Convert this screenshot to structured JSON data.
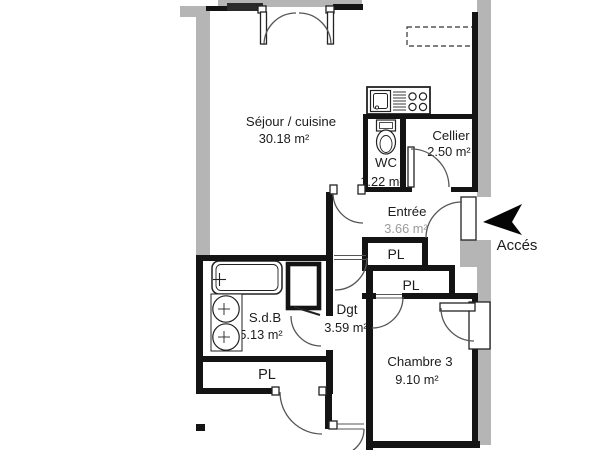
{
  "plan_type": "apartment-floor-plan",
  "colors": {
    "wall": "#141414",
    "masonry_gray": "#b5b5b5",
    "door_arc": "#555555",
    "label": "#1c1c1c",
    "faded_label": "#9b9b9b",
    "background": "#ffffff"
  },
  "rooms": {
    "sejour": {
      "name": "Séjour / cuisine",
      "area": "30.18 m²"
    },
    "wc": {
      "name": "WC",
      "area": "1.22 m²"
    },
    "cellier": {
      "name": "Cellier",
      "area": "2.50 m²"
    },
    "entree": {
      "name": "Entrée",
      "area": "3.66 m²"
    },
    "sdb": {
      "name": "S.d.B",
      "area": "5.13 m²"
    },
    "dgt": {
      "name": "Dgt",
      "area": "3.59 m²"
    },
    "chambre3": {
      "name": "Chambre 3",
      "area": "9.10 m²"
    }
  },
  "closets": [
    {
      "label": "PL"
    },
    {
      "label": "PL"
    },
    {
      "label": "PL"
    }
  ],
  "access": {
    "label": "Accés"
  },
  "fixtures": {
    "kitchen": [
      "sink-icon",
      "stove-burners-icon"
    ],
    "wc": [
      "toilet-icon"
    ],
    "sdb": [
      "bathtub-icon",
      "washbasin-icon",
      "washbasin-icon"
    ],
    "other": [
      "duct-box",
      "dashed-overhead-cabinet",
      "access-arrow-icon"
    ]
  }
}
